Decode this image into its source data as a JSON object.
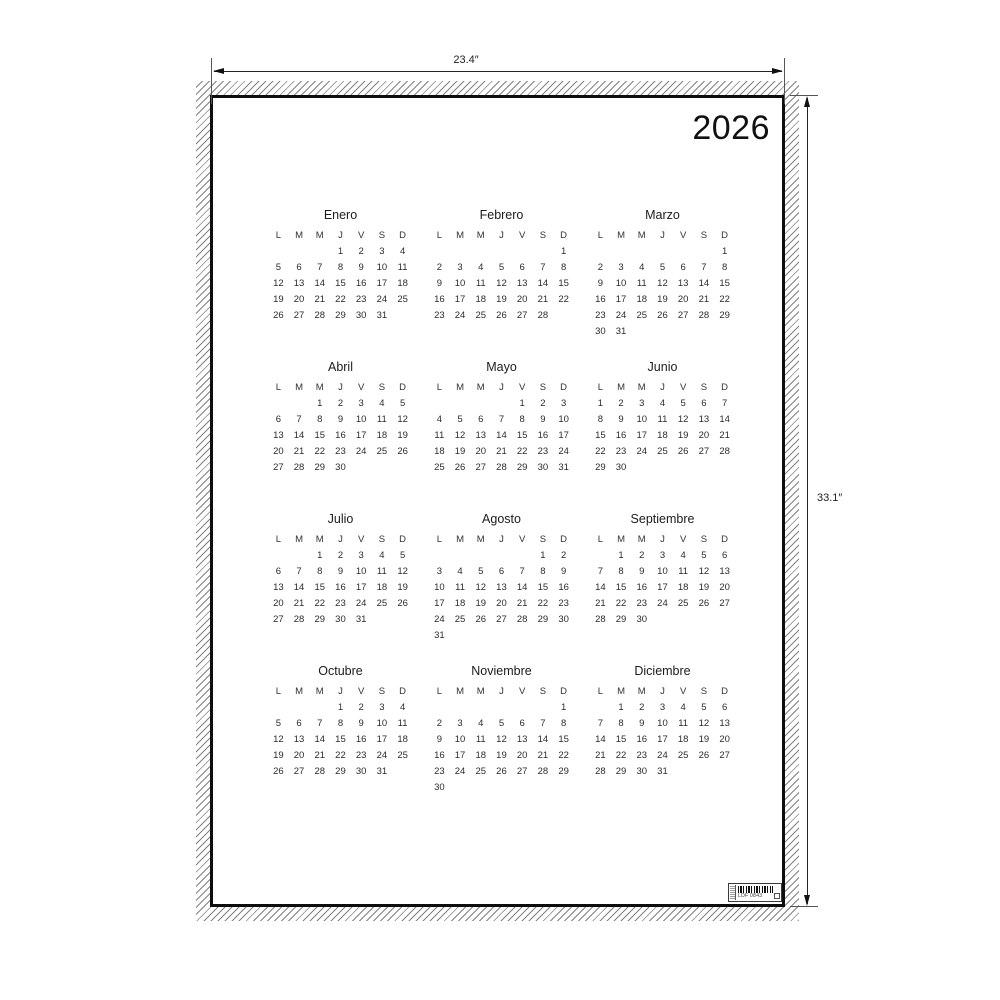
{
  "year": "2026",
  "dimensions": {
    "width_label": "23.4″",
    "height_label": "33.1″"
  },
  "weekday_headers": [
    "L",
    "M",
    "M",
    "J",
    "V",
    "S",
    "D"
  ],
  "months": [
    {
      "name": "Enero",
      "weeks": [
        [
          "",
          "",
          "",
          "1",
          "2",
          "3",
          "4"
        ],
        [
          "5",
          "6",
          "7",
          "8",
          "9",
          "10",
          "11"
        ],
        [
          "12",
          "13",
          "14",
          "15",
          "16",
          "17",
          "18"
        ],
        [
          "19",
          "20",
          "21",
          "22",
          "23",
          "24",
          "25"
        ],
        [
          "26",
          "27",
          "28",
          "29",
          "30",
          "31",
          ""
        ]
      ]
    },
    {
      "name": "Febrero",
      "weeks": [
        [
          "",
          "",
          "",
          "",
          "",
          "",
          "1"
        ],
        [
          "2",
          "3",
          "4",
          "5",
          "6",
          "7",
          "8"
        ],
        [
          "9",
          "10",
          "11",
          "12",
          "13",
          "14",
          "15"
        ],
        [
          "16",
          "17",
          "18",
          "19",
          "20",
          "21",
          "22"
        ],
        [
          "23",
          "24",
          "25",
          "26",
          "27",
          "28",
          ""
        ]
      ]
    },
    {
      "name": "Marzo",
      "weeks": [
        [
          "",
          "",
          "",
          "",
          "",
          "",
          "1"
        ],
        [
          "2",
          "3",
          "4",
          "5",
          "6",
          "7",
          "8"
        ],
        [
          "9",
          "10",
          "11",
          "12",
          "13",
          "14",
          "15"
        ],
        [
          "16",
          "17",
          "18",
          "19",
          "20",
          "21",
          "22"
        ],
        [
          "23",
          "24",
          "25",
          "26",
          "27",
          "28",
          "29"
        ],
        [
          "30",
          "31",
          "",
          "",
          "",
          "",
          ""
        ]
      ]
    },
    {
      "name": "Abril",
      "weeks": [
        [
          "",
          "",
          "1",
          "2",
          "3",
          "4",
          "5"
        ],
        [
          "6",
          "7",
          "8",
          "9",
          "10",
          "11",
          "12"
        ],
        [
          "13",
          "14",
          "15",
          "16",
          "17",
          "18",
          "19"
        ],
        [
          "20",
          "21",
          "22",
          "23",
          "24",
          "25",
          "26"
        ],
        [
          "27",
          "28",
          "29",
          "30",
          "",
          "",
          ""
        ]
      ]
    },
    {
      "name": "Mayo",
      "weeks": [
        [
          "",
          "",
          "",
          "",
          "1",
          "2",
          "3"
        ],
        [
          "4",
          "5",
          "6",
          "7",
          "8",
          "9",
          "10"
        ],
        [
          "11",
          "12",
          "13",
          "14",
          "15",
          "16",
          "17"
        ],
        [
          "18",
          "19",
          "20",
          "21",
          "22",
          "23",
          "24"
        ],
        [
          "25",
          "26",
          "27",
          "28",
          "29",
          "30",
          "31"
        ]
      ]
    },
    {
      "name": "Junio",
      "weeks": [
        [
          "1",
          "2",
          "3",
          "4",
          "5",
          "6",
          "7"
        ],
        [
          "8",
          "9",
          "10",
          "11",
          "12",
          "13",
          "14"
        ],
        [
          "15",
          "16",
          "17",
          "18",
          "19",
          "20",
          "21"
        ],
        [
          "22",
          "23",
          "24",
          "25",
          "26",
          "27",
          "28"
        ],
        [
          "29",
          "30",
          "",
          "",
          "",
          "",
          ""
        ]
      ]
    },
    {
      "name": "Julio",
      "weeks": [
        [
          "",
          "",
          "1",
          "2",
          "3",
          "4",
          "5"
        ],
        [
          "6",
          "7",
          "8",
          "9",
          "10",
          "11",
          "12"
        ],
        [
          "13",
          "14",
          "15",
          "16",
          "17",
          "18",
          "19"
        ],
        [
          "20",
          "21",
          "22",
          "23",
          "24",
          "25",
          "26"
        ],
        [
          "27",
          "28",
          "29",
          "30",
          "31",
          "",
          ""
        ]
      ]
    },
    {
      "name": "Agosto",
      "weeks": [
        [
          "",
          "",
          "",
          "",
          "",
          "1",
          "2"
        ],
        [
          "3",
          "4",
          "5",
          "6",
          "7",
          "8",
          "9"
        ],
        [
          "10",
          "11",
          "12",
          "13",
          "14",
          "15",
          "16"
        ],
        [
          "17",
          "18",
          "19",
          "20",
          "21",
          "22",
          "23"
        ],
        [
          "24",
          "25",
          "26",
          "27",
          "28",
          "29",
          "30"
        ],
        [
          "31",
          "",
          "",
          "",
          "",
          "",
          ""
        ]
      ]
    },
    {
      "name": "Septiembre",
      "weeks": [
        [
          "",
          "1",
          "2",
          "3",
          "4",
          "5",
          "6"
        ],
        [
          "7",
          "8",
          "9",
          "10",
          "11",
          "12",
          "13"
        ],
        [
          "14",
          "15",
          "16",
          "17",
          "18",
          "19",
          "20"
        ],
        [
          "21",
          "22",
          "23",
          "24",
          "25",
          "26",
          "27"
        ],
        [
          "28",
          "29",
          "30",
          "",
          "",
          "",
          ""
        ]
      ]
    },
    {
      "name": "Octubre",
      "weeks": [
        [
          "",
          "",
          "",
          "1",
          "2",
          "3",
          "4"
        ],
        [
          "5",
          "6",
          "7",
          "8",
          "9",
          "10",
          "11"
        ],
        [
          "12",
          "13",
          "14",
          "15",
          "16",
          "17",
          "18"
        ],
        [
          "19",
          "20",
          "21",
          "22",
          "23",
          "24",
          "25"
        ],
        [
          "26",
          "27",
          "28",
          "29",
          "30",
          "31",
          ""
        ]
      ]
    },
    {
      "name": "Noviembre",
      "weeks": [
        [
          "",
          "",
          "",
          "",
          "",
          "",
          "1"
        ],
        [
          "2",
          "3",
          "4",
          "5",
          "6",
          "7",
          "8"
        ],
        [
          "9",
          "10",
          "11",
          "12",
          "13",
          "14",
          "15"
        ],
        [
          "16",
          "17",
          "18",
          "19",
          "20",
          "21",
          "22"
        ],
        [
          "23",
          "24",
          "25",
          "26",
          "27",
          "28",
          "29"
        ],
        [
          "30",
          "",
          "",
          "",
          "",
          "",
          ""
        ]
      ]
    },
    {
      "name": "Diciembre",
      "weeks": [
        [
          "",
          "1",
          "2",
          "3",
          "4",
          "5",
          "6"
        ],
        [
          "7",
          "8",
          "9",
          "10",
          "11",
          "12",
          "13"
        ],
        [
          "14",
          "15",
          "16",
          "17",
          "18",
          "19",
          "20"
        ],
        [
          "21",
          "22",
          "23",
          "24",
          "25",
          "26",
          "27"
        ],
        [
          "28",
          "29",
          "30",
          "31",
          "",
          "",
          ""
        ]
      ]
    }
  ],
  "product_label": {
    "code": "LDF 0843"
  },
  "colors": {
    "ink": "#1a1a1a",
    "frame": "#0d0d0d",
    "hatch": "#6b6b6b"
  }
}
